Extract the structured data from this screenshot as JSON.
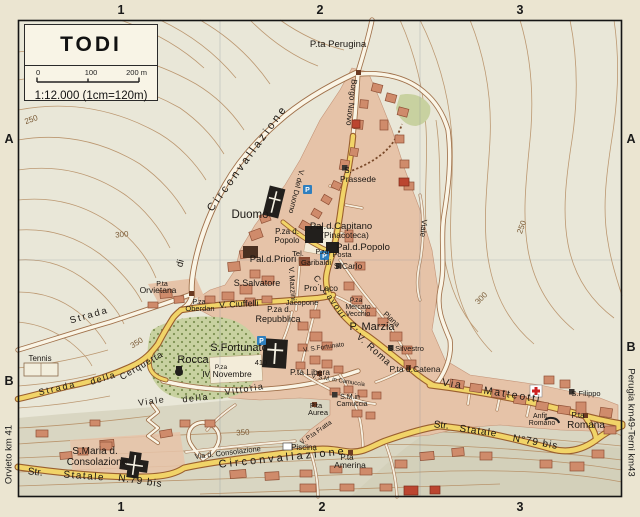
{
  "title_box": {
    "title": "TODI",
    "scale_ticks": [
      "0",
      "100",
      "200 m"
    ],
    "ratio_text": "1:12.000 (1cm=120m)"
  },
  "grid_refs": {
    "top": [
      "1",
      "2",
      "3"
    ],
    "bottom": [
      "1",
      "2",
      "3"
    ],
    "left": [
      "A",
      "B"
    ],
    "right": [
      "A",
      "B"
    ]
  },
  "edge_labels": {
    "left": "Orvieto km 41",
    "right": "Perugia km49-Terni km43"
  },
  "colors": {
    "paper": "#ebe5d1",
    "terrain": "#e9e7d8",
    "town_pink": "#e6c3a8",
    "building": "#cf8b6b",
    "monument_black": "#221f1c",
    "road_yellow": "#f1d468",
    "road_casing": "#9a5f2f",
    "park_green": "#c8d1a0",
    "contour_brown": "#b48a5f",
    "parking_blue": "#2f7fbe",
    "cross_red": "#cc2222"
  },
  "map": {
    "labels": [
      {
        "t": "P.ta Perugina",
        "x": 338,
        "y": 47,
        "s": 9.5
      },
      {
        "t": "S.",
        "x": 348,
        "y": 173,
        "s": 8
      },
      {
        "t": "Prassede",
        "x": 358,
        "y": 182,
        "s": 8.5
      },
      {
        "t": "Duomo",
        "x": 250,
        "y": 218,
        "s": 11.5
      },
      {
        "t": "Pal.d.Capitano",
        "x": 341,
        "y": 229,
        "s": 9.5
      },
      {
        "t": "(Pinacoteca)",
        "x": 345,
        "y": 238,
        "s": 8.5
      },
      {
        "t": "Pal.d.Popolo",
        "x": 363,
        "y": 250,
        "s": 9.5
      },
      {
        "t": "P.za d.",
        "x": 287,
        "y": 234,
        "s": 8
      },
      {
        "t": "Popolo",
        "x": 287,
        "y": 243,
        "s": 8
      },
      {
        "t": "Tel.",
        "x": 298,
        "y": 256,
        "s": 7.5
      },
      {
        "t": "P.za",
        "x": 322,
        "y": 254,
        "s": 7
      },
      {
        "t": "Garibaldi",
        "x": 316,
        "y": 265,
        "s": 7.5
      },
      {
        "t": "Posta",
        "x": 342,
        "y": 257,
        "s": 7.5
      },
      {
        "t": "Pal.d.Priori",
        "x": 273,
        "y": 262,
        "s": 9.5
      },
      {
        "t": "S.Carlo",
        "x": 348,
        "y": 269,
        "s": 8.5
      },
      {
        "t": "Pro Loco",
        "x": 321,
        "y": 291,
        "s": 8.5
      },
      {
        "t": "Jacopone",
        "x": 302,
        "y": 305,
        "s": 7.5
      },
      {
        "t": "P.za d.",
        "x": 279,
        "y": 312,
        "s": 8
      },
      {
        "t": "Repubblica",
        "x": 278,
        "y": 322,
        "s": 9
      },
      {
        "t": "S.Salvatore",
        "x": 257,
        "y": 286,
        "s": 9
      },
      {
        "t": "V. Ciuffelli",
        "x": 239,
        "y": 307,
        "s": 9,
        "r": -3
      },
      {
        "t": "P.za",
        "x": 199,
        "y": 304,
        "s": 7
      },
      {
        "t": "Oberdan",
        "x": 200,
        "y": 311,
        "s": 7.5
      },
      {
        "t": "P.ta",
        "x": 162,
        "y": 286,
        "s": 7
      },
      {
        "t": "Orvietana",
        "x": 158,
        "y": 293,
        "s": 8.5
      },
      {
        "t": "Strada",
        "x": 90,
        "y": 318,
        "s": 9.5,
        "r": -16,
        "sp": 2
      },
      {
        "t": "di",
        "x": 183,
        "y": 264,
        "s": 9.5,
        "r": -75
      },
      {
        "t": "Circonvallazione",
        "x": 250,
        "y": 160,
        "s": 11,
        "r": -54,
        "sp": 3
      },
      {
        "t": "Borgo Nuovo",
        "x": 349,
        "y": 102,
        "s": 8,
        "r": 97
      },
      {
        "t": "V. del Duomo",
        "x": 294,
        "y": 191,
        "s": 7.5,
        "r": 104
      },
      {
        "t": "V. Mazzini",
        "x": 290,
        "y": 284,
        "s": 7.5,
        "r": 86
      },
      {
        "t": "C. Cavour",
        "x": 328,
        "y": 299,
        "s": 8.5,
        "r": 55,
        "sp": 1.5
      },
      {
        "t": "P. Marzia",
        "x": 372,
        "y": 330,
        "s": 11
      },
      {
        "t": "P.za",
        "x": 356,
        "y": 302,
        "s": 6.5
      },
      {
        "t": "Mercato",
        "x": 358,
        "y": 309,
        "s": 7
      },
      {
        "t": "Vecchio",
        "x": 358,
        "y": 316,
        "s": 7
      },
      {
        "t": "Piana",
        "x": 390,
        "y": 321,
        "s": 7.5,
        "r": 42
      },
      {
        "t": "S.Silvestro",
        "x": 406,
        "y": 351,
        "s": 7.5
      },
      {
        "t": "P.ta d.Catena",
        "x": 415,
        "y": 372,
        "s": 8.5
      },
      {
        "t": "V. Roma",
        "x": 372,
        "y": 352,
        "s": 9.5,
        "r": 42,
        "sp": 1
      },
      {
        "t": "P.ta Libera",
        "x": 310,
        "y": 375,
        "s": 8.5
      },
      {
        "t": "V. S.M. in Camuccia",
        "x": 338,
        "y": 382,
        "s": 6,
        "r": 9
      },
      {
        "t": "S.M.in",
        "x": 350,
        "y": 399,
        "s": 7
      },
      {
        "t": "Camuccia",
        "x": 352,
        "y": 406,
        "s": 7
      },
      {
        "t": "P.ta",
        "x": 316,
        "y": 408,
        "s": 7.5
      },
      {
        "t": "Aurea",
        "x": 318,
        "y": 415,
        "s": 7.5
      },
      {
        "t": "V. S.Fortunato",
        "x": 324,
        "y": 349,
        "s": 6.5,
        "r": -8
      },
      {
        "t": "S.Fortunato",
        "x": 239,
        "y": 351,
        "s": 11
      },
      {
        "t": "410",
        "x": 261,
        "y": 365,
        "s": 7.5
      },
      {
        "t": "Rocca",
        "x": 193,
        "y": 363,
        "s": 11
      },
      {
        "t": "P.za",
        "x": 221,
        "y": 369,
        "s": 6.5
      },
      {
        "t": "IV Novembre",
        "x": 227,
        "y": 377,
        "s": 8.5
      },
      {
        "t": "Viale",
        "x": 152,
        "y": 404,
        "s": 9,
        "r": -8,
        "sp": 1.5
      },
      {
        "t": "della",
        "x": 196,
        "y": 401,
        "s": 9,
        "r": -6,
        "sp": 1.5
      },
      {
        "t": "Vittoria",
        "x": 245,
        "y": 392,
        "s": 9,
        "r": -9,
        "sp": 1.5
      },
      {
        "t": "Strada",
        "x": 58,
        "y": 391,
        "s": 9,
        "r": -13,
        "sp": 2
      },
      {
        "t": "della",
        "x": 104,
        "y": 381,
        "s": 9,
        "r": -17,
        "sp": 1.5
      },
      {
        "t": "Cerquetta",
        "x": 143,
        "y": 368,
        "s": 9,
        "r": -30,
        "sp": 1
      },
      {
        "t": "Tennis",
        "x": 40,
        "y": 361,
        "s": 8
      },
      {
        "t": "S.Maria d.",
        "x": 95,
        "y": 454,
        "s": 10
      },
      {
        "t": "Consolazione",
        "x": 97,
        "y": 465,
        "s": 10
      },
      {
        "t": "Str.",
        "x": 35,
        "y": 475,
        "s": 10,
        "r": 6
      },
      {
        "t": "Statale",
        "x": 84,
        "y": 479,
        "s": 10,
        "r": 4,
        "sp": 1.5
      },
      {
        "t": "N.79 bis",
        "x": 140,
        "y": 484,
        "s": 10,
        "r": 8,
        "sp": 1
      },
      {
        "t": "Via d. Consolazione",
        "x": 228,
        "y": 455,
        "s": 7.5,
        "r": -7
      },
      {
        "t": "Circonvallazione",
        "x": 283,
        "y": 461,
        "s": 11,
        "r": -6,
        "sp": 3
      },
      {
        "t": "Piscina",
        "x": 304,
        "y": 450,
        "s": 8
      },
      {
        "t": "V. P.ta Fratta",
        "x": 317,
        "y": 434,
        "s": 6.5,
        "r": -35
      },
      {
        "t": "P.ta",
        "x": 347,
        "y": 460,
        "s": 8
      },
      {
        "t": "Amerina",
        "x": 350,
        "y": 468,
        "s": 8.5
      },
      {
        "t": "Via",
        "x": 452,
        "y": 387,
        "s": 10.5,
        "r": 9,
        "sp": 2
      },
      {
        "t": "Matteotti",
        "x": 512,
        "y": 398,
        "s": 10.5,
        "r": 9,
        "sp": 2
      },
      {
        "t": "S.Filippo",
        "x": 586,
        "y": 396,
        "s": 7.5
      },
      {
        "t": "Anfit.",
        "x": 541,
        "y": 418,
        "s": 7
      },
      {
        "t": "Romano",
        "x": 542,
        "y": 425,
        "s": 7
      },
      {
        "t": "P.ta",
        "x": 578,
        "y": 418,
        "s": 8
      },
      {
        "t": "Romana",
        "x": 586,
        "y": 428,
        "s": 10
      },
      {
        "t": "Str.",
        "x": 441,
        "y": 428,
        "s": 10,
        "r": 6
      },
      {
        "t": "Statale",
        "x": 478,
        "y": 434,
        "s": 10,
        "r": 8,
        "sp": 1
      },
      {
        "t": "N°79 bis",
        "x": 535,
        "y": 445,
        "s": 10,
        "r": 10,
        "sp": 1
      },
      {
        "t": "Viale",
        "x": 421,
        "y": 228,
        "s": 8,
        "r": 95
      },
      {
        "t": "250",
        "x": 32,
        "y": 122,
        "s": 8,
        "r": -20,
        "k": "contour-lbl"
      },
      {
        "t": "300",
        "x": 122,
        "y": 237,
        "s": 8,
        "r": -5,
        "k": "contour-lbl"
      },
      {
        "t": "350",
        "x": 138,
        "y": 345,
        "s": 8,
        "r": -32,
        "k": "contour-lbl"
      },
      {
        "t": "250",
        "x": 524,
        "y": 228,
        "s": 8,
        "r": -70,
        "k": "contour-lbl"
      },
      {
        "t": "300",
        "x": 483,
        "y": 300,
        "s": 8,
        "r": -45,
        "k": "contour-lbl"
      },
      {
        "t": "350",
        "x": 243,
        "y": 435,
        "s": 8,
        "r": -4,
        "k": "contour-lbl"
      }
    ],
    "icons": [
      {
        "type": "parking",
        "glyph": "P",
        "x": 303,
        "y": 185
      },
      {
        "type": "parking",
        "glyph": "P",
        "x": 257,
        "y": 336
      },
      {
        "type": "posta",
        "glyph": "P",
        "x": 320,
        "y": 251
      },
      {
        "type": "hospital",
        "x": 530,
        "y": 385
      },
      {
        "type": "marker",
        "x": 342,
        "y": 165
      },
      {
        "type": "marker",
        "x": 336,
        "y": 263
      },
      {
        "type": "marker",
        "x": 388,
        "y": 345
      },
      {
        "type": "marker",
        "x": 569,
        "y": 389
      },
      {
        "type": "marker",
        "x": 332,
        "y": 392
      },
      {
        "type": "gate",
        "x": 356,
        "y": 70
      },
      {
        "type": "gate",
        "x": 189,
        "y": 291
      },
      {
        "type": "gate",
        "x": 583,
        "y": 413
      },
      {
        "type": "gate",
        "x": 348,
        "y": 450
      },
      {
        "type": "gate",
        "x": 317,
        "y": 371
      },
      {
        "type": "gate",
        "x": 312,
        "y": 402
      },
      {
        "type": "gate",
        "x": 406,
        "y": 365
      }
    ]
  }
}
